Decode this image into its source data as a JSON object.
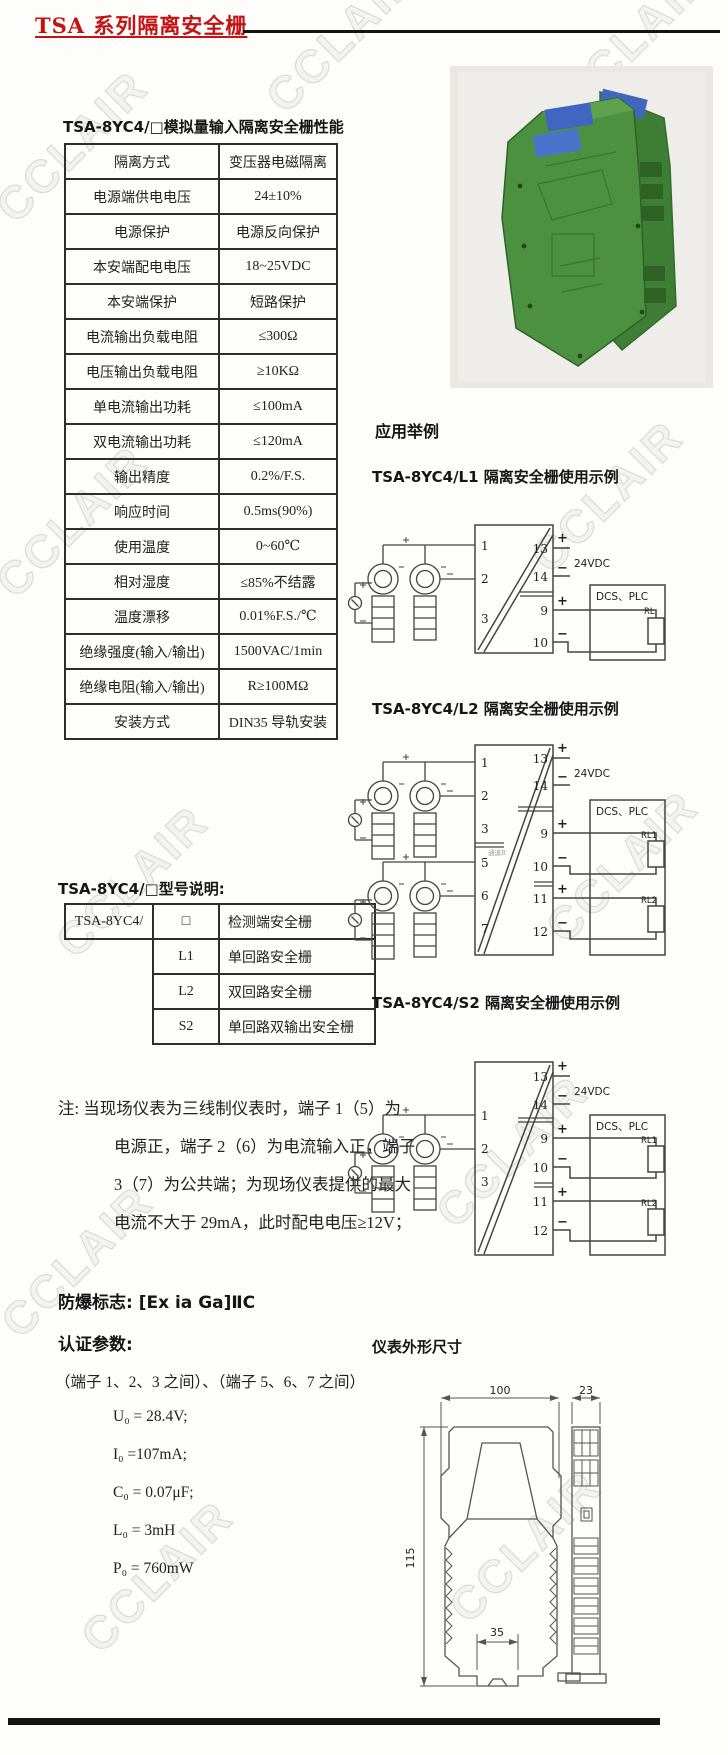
{
  "page": {
    "title": "TSA 系列隔离安全栅",
    "watermark": "CCLAIR",
    "colors": {
      "title_red": "#c41212",
      "module_green": "#4c9140",
      "terminal_blue": "#3f66c0"
    }
  },
  "perf": {
    "heading": "TSA-8YC4/□模拟量输入隔离安全栅性能",
    "rows": [
      {
        "label": "隔离方式",
        "value": "变压器电磁隔离"
      },
      {
        "label": "电源端供电电压",
        "value": "24±10%"
      },
      {
        "label": "电源保护",
        "value": "电源反向保护"
      },
      {
        "label": "本安端配电电压",
        "value": "18~25VDC"
      },
      {
        "label": "本安端保护",
        "value": "短路保护"
      },
      {
        "label": "电流输出负载电阻",
        "value": "≤300Ω"
      },
      {
        "label": "电压输出负载电阻",
        "value": "≥10KΩ"
      },
      {
        "label": "单电流输出功耗",
        "value": "≤100mA"
      },
      {
        "label": "双电流输出功耗",
        "value": "≤120mA"
      },
      {
        "label": "输出精度",
        "value": "0.2%/F.S."
      },
      {
        "label": "响应时间",
        "value": "0.5ms(90%)"
      },
      {
        "label": "使用温度",
        "value": "0~60℃"
      },
      {
        "label": "相对湿度",
        "value": "≤85%不结露"
      },
      {
        "label": "温度漂移",
        "value": "0.01%F.S./℃"
      },
      {
        "label": "绝缘强度(输入/输出)",
        "value": "1500VAC/1min"
      },
      {
        "label": "绝缘电阻(输入/输出)",
        "value": "R≥100MΩ"
      },
      {
        "label": "安装方式",
        "value": "DIN35 导轨安装"
      }
    ]
  },
  "model": {
    "heading": "TSA-8YC4/□型号说明:",
    "prefix": "TSA-8YC4/",
    "rows": [
      {
        "code": "□",
        "desc": "检测端安全栅"
      },
      {
        "code": "L1",
        "desc": "单回路安全栅"
      },
      {
        "code": "L2",
        "desc": "双回路安全栅"
      },
      {
        "code": "S2",
        "desc": "单回路双输出安全栅"
      }
    ]
  },
  "note": {
    "lines": [
      "注: 当现场仪表为三线制仪表时，端子 1（5）为",
      "电源正，端子 2（6）为电流输入正，端子",
      "3（7）为公共端；为现场仪表提供的最大",
      "电流不大于 29mA，此时配电电压≥12V；"
    ]
  },
  "cert": {
    "ex_mark": "防爆标志: [Ex ia Ga]ⅡC",
    "params_heading": "认证参数:",
    "terminals_line": "（端子 1、2、3 之间）、（端子 5、6、7 之间）",
    "params": [
      "U₀ = 28.4V;",
      "I₀ =107mA;",
      "C₀ = 0.07μF;",
      "L₀ = 3mH",
      "P₀ = 760mW"
    ]
  },
  "app": {
    "heading": "应用举例",
    "plus": "+",
    "minus": "−",
    "l1": {
      "title": "TSA-8YC4/L1 隔离安全栅使用示例",
      "t1": "1",
      "t2": "2",
      "t3": "3",
      "t13": "13",
      "t14": "14",
      "t9": "9",
      "t10": "10",
      "supply": "24VDC",
      "dcs": "DCS、PLC",
      "rl": "RL"
    },
    "l2": {
      "title": "TSA-8YC4/L2 隔离安全栅使用示例",
      "t1": "1",
      "t2": "2",
      "t3": "3",
      "t5": "5",
      "t6": "6",
      "t7": "7",
      "t13": "13",
      "t14": "14",
      "t9": "9",
      "t10": "10",
      "t11": "11",
      "t12": "12",
      "supply": "24VDC",
      "dcs": "DCS、PLC",
      "rl1": "RL1",
      "rl2": "RL2",
      "channel": "通道B"
    },
    "s2": {
      "title": "TSA-8YC4/S2 隔离安全栅使用示例",
      "t1": "1",
      "t2": "2",
      "t3": "3",
      "t13": "13",
      "t14": "14",
      "t9": "9",
      "t10": "10",
      "t11": "11",
      "t12": "12",
      "supply": "24VDC",
      "dcs": "DCS、PLC",
      "rl1": "RL1",
      "rl2": "RL2"
    }
  },
  "dims": {
    "heading": "仪表外形尺寸",
    "front_width": "100",
    "side_width": "23",
    "height": "115",
    "foot": "35"
  }
}
